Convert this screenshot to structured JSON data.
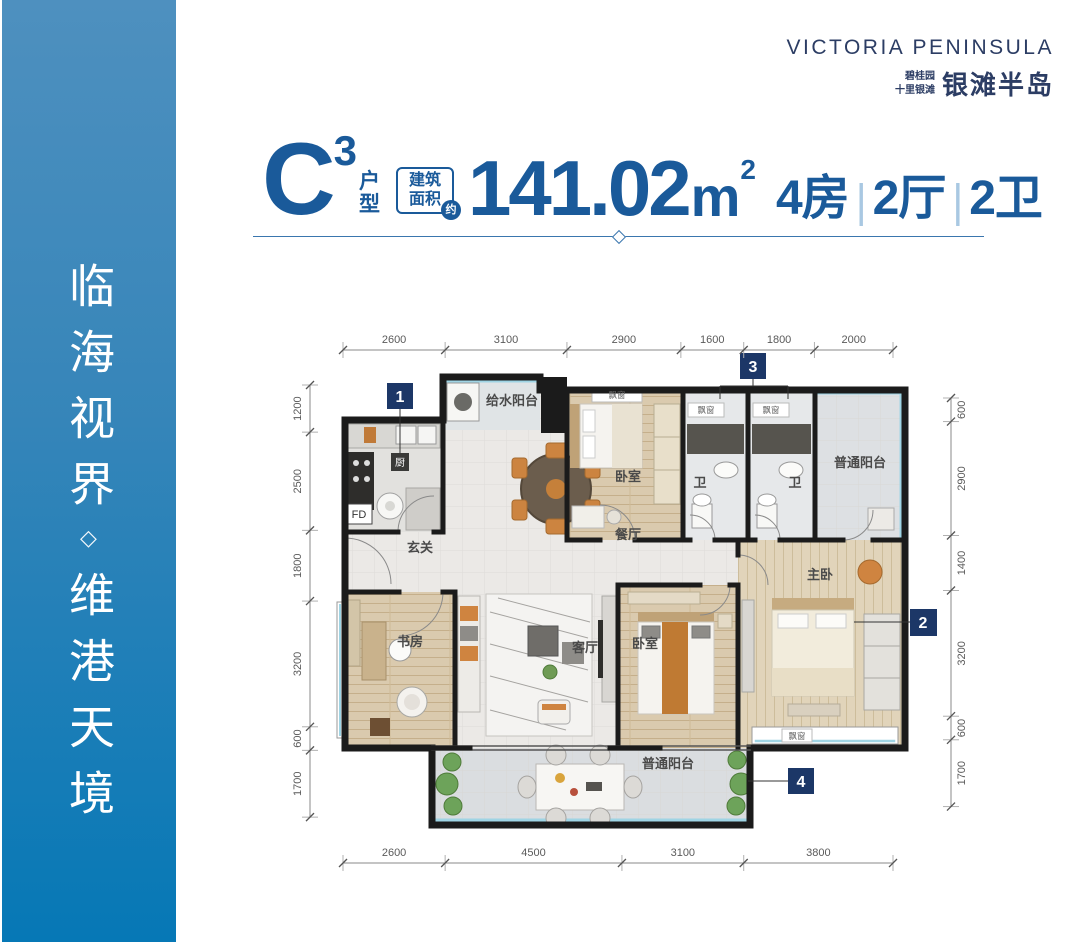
{
  "sidebar": {
    "line1": "临海视界",
    "separator": "◇",
    "line2": "维港天境"
  },
  "logo": {
    "english": "VICTORIA PENINSULA",
    "brand_small_1": "碧桂园",
    "brand_small_2": "十里银滩",
    "brand_large": "银滩半岛"
  },
  "title": {
    "unit_letter": "C",
    "unit_sup": "3",
    "unit_char_1": "户",
    "unit_char_2": "型",
    "area_label_1": "建筑",
    "area_label_2": "面积",
    "area_approx": "约",
    "area_value": "141.02",
    "area_unit": "m",
    "area_unit_sup": "2",
    "bedrooms": "4房",
    "separator": "|",
    "halls": "2厅",
    "baths": "2卫"
  },
  "colors": {
    "accent": "#1A5A9A",
    "marker": "#1C3767",
    "logo_navy": "#2C3D64",
    "sidebar_top": "#4E90BF",
    "sidebar_bottom": "#0678B6",
    "glazing": "#9FD4E4"
  },
  "floorplan": {
    "rooms": {
      "kitchen": "厨",
      "supply_balcony": "给水阳台",
      "dining": "餐厅",
      "entry": "玄关",
      "bedroom_top": "卧室",
      "bath": "卫",
      "balcony": "普通阳台",
      "study": "书房",
      "living": "客厅",
      "bedroom_mid": "卧室",
      "master": "主卧",
      "bay_window": "飘窗",
      "fd": "FD"
    },
    "markers": [
      {
        "label": "1"
      },
      {
        "label": "2"
      },
      {
        "label": "3"
      },
      {
        "label": "4"
      }
    ],
    "dimensions": {
      "top": [
        2600,
        3100,
        2900,
        1600,
        1800,
        2000
      ],
      "bottom": [
        2600,
        4500,
        3100,
        3800
      ],
      "left": [
        1200,
        2500,
        1800,
        3200,
        600,
        1700
      ],
      "right": [
        600,
        2900,
        1400,
        3200,
        600,
        1700
      ]
    }
  }
}
